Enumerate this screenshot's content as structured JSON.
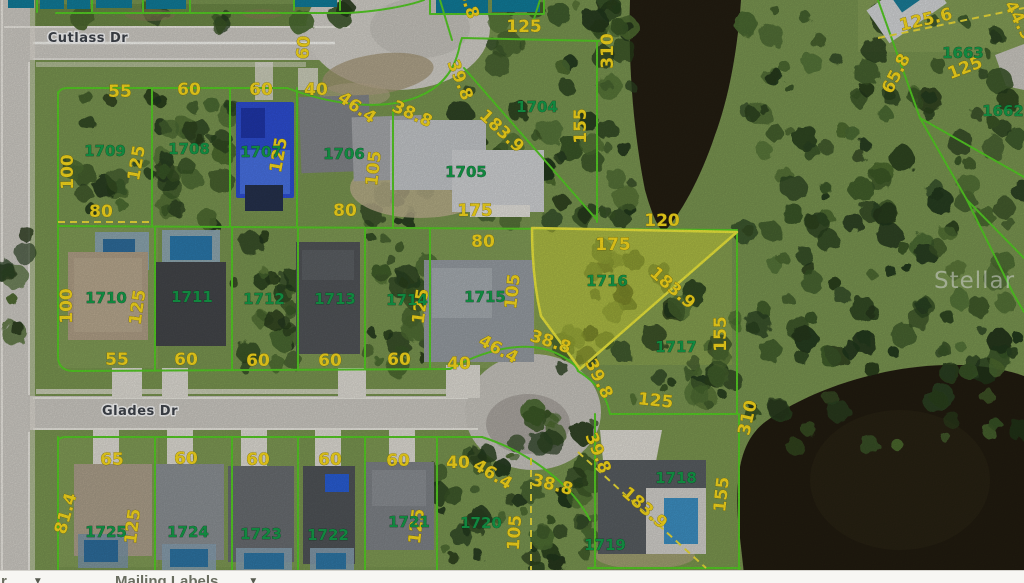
{
  "map": {
    "watermark": "Stellar MLS",
    "streets": [
      {
        "name": "Cutlass Dr",
        "x": 88,
        "y": 42
      },
      {
        "name": "Glades Dr",
        "x": 140,
        "y": 415
      }
    ],
    "lot_numbers": [
      {
        "id": "1704",
        "x": 537,
        "y": 112
      },
      {
        "id": "1705",
        "x": 466,
        "y": 177
      },
      {
        "id": "1706",
        "x": 344,
        "y": 159
      },
      {
        "id": "1707",
        "x": 261,
        "y": 157
      },
      {
        "id": "1708",
        "x": 189,
        "y": 154
      },
      {
        "id": "1709",
        "x": 105,
        "y": 156
      },
      {
        "id": "1710",
        "x": 106,
        "y": 303
      },
      {
        "id": "1711",
        "x": 192,
        "y": 302
      },
      {
        "id": "1712",
        "x": 264,
        "y": 304
      },
      {
        "id": "1713",
        "x": 335,
        "y": 304
      },
      {
        "id": "1714",
        "x": 407,
        "y": 305
      },
      {
        "id": "1715",
        "x": 485,
        "y": 302
      },
      {
        "id": "1716",
        "x": 607,
        "y": 286
      },
      {
        "id": "1717",
        "x": 676,
        "y": 352
      },
      {
        "id": "1718",
        "x": 676,
        "y": 483
      },
      {
        "id": "1719",
        "x": 605,
        "y": 550
      },
      {
        "id": "1720",
        "x": 481,
        "y": 528
      },
      {
        "id": "1721",
        "x": 409,
        "y": 527
      },
      {
        "id": "1722",
        "x": 328,
        "y": 540
      },
      {
        "id": "1723",
        "x": 261,
        "y": 539
      },
      {
        "id": "1724",
        "x": 188,
        "y": 537
      },
      {
        "id": "1725",
        "x": 106,
        "y": 537
      },
      {
        "id": "1662",
        "x": 1003,
        "y": 116
      },
      {
        "id": "1663",
        "x": 963,
        "y": 58
      }
    ],
    "dimensions": [
      {
        "t": "55",
        "x": 120,
        "y": 97
      },
      {
        "t": "60",
        "x": 189,
        "y": 95
      },
      {
        "t": "60",
        "x": 261,
        "y": 95
      },
      {
        "t": "40",
        "x": 316,
        "y": 95
      },
      {
        "t": "60",
        "x": 309,
        "y": 48,
        "r": -85,
        "s": 15
      },
      {
        "t": "100",
        "x": 73,
        "y": 172,
        "r": -90
      },
      {
        "t": "80",
        "x": 101,
        "y": 217
      },
      {
        "t": "125",
        "x": 142,
        "y": 164,
        "r": -80
      },
      {
        "t": "125",
        "x": 284,
        "y": 156,
        "r": -80
      },
      {
        "t": "46.4",
        "x": 354,
        "y": 112,
        "r": 35
      },
      {
        "t": "38.8",
        "x": 410,
        "y": 119,
        "r": 24
      },
      {
        "t": "39.8",
        "x": 455,
        "y": 82,
        "r": 68
      },
      {
        "t": "183.9",
        "x": 498,
        "y": 135,
        "r": 43
      },
      {
        "t": "38.8",
        "x": 462,
        "y": 0,
        "r": 72
      },
      {
        "t": "125",
        "x": 524,
        "y": 32
      },
      {
        "t": "310",
        "x": 613,
        "y": 51,
        "r": -90
      },
      {
        "t": "155",
        "x": 586,
        "y": 126,
        "r": -90
      },
      {
        "t": "105",
        "x": 379,
        "y": 169,
        "r": -84
      },
      {
        "t": "80",
        "x": 345,
        "y": 216
      },
      {
        "t": "175",
        "x": 475,
        "y": 216
      },
      {
        "t": "125.6",
        "x": 927,
        "y": 25,
        "r": -13,
        "s": 15
      },
      {
        "t": "44.9",
        "x": 1014,
        "y": 23,
        "r": 62,
        "s": 15
      },
      {
        "t": "65.8",
        "x": 901,
        "y": 76,
        "r": -63,
        "s": 15
      },
      {
        "t": "125",
        "x": 967,
        "y": 73,
        "r": -21,
        "s": 15
      },
      {
        "t": "100",
        "x": 72,
        "y": 306,
        "r": -90
      },
      {
        "t": "125",
        "x": 143,
        "y": 308,
        "r": -82
      },
      {
        "t": "80",
        "x": 483,
        "y": 247
      },
      {
        "t": "105",
        "x": 518,
        "y": 292,
        "r": -84
      },
      {
        "t": "175",
        "x": 613,
        "y": 250
      },
      {
        "t": "120",
        "x": 662,
        "y": 226
      },
      {
        "t": "183.9",
        "x": 669,
        "y": 292,
        "r": 41
      },
      {
        "t": "155",
        "x": 726,
        "y": 334,
        "r": -90
      },
      {
        "t": "125",
        "x": 426,
        "y": 307,
        "r": -82
      },
      {
        "t": "55",
        "x": 117,
        "y": 365
      },
      {
        "t": "60",
        "x": 186,
        "y": 365
      },
      {
        "t": "60",
        "x": 258,
        "y": 366
      },
      {
        "t": "60",
        "x": 330,
        "y": 366
      },
      {
        "t": "60",
        "x": 399,
        "y": 365
      },
      {
        "t": "40",
        "x": 459,
        "y": 369
      },
      {
        "t": "46.4",
        "x": 496,
        "y": 354,
        "r": 28
      },
      {
        "t": "38.8",
        "x": 549,
        "y": 347,
        "r": 18
      },
      {
        "t": "39.8",
        "x": 594,
        "y": 381,
        "r": 64
      },
      {
        "t": "125",
        "x": 655,
        "y": 406,
        "r": 6
      },
      {
        "t": "65",
        "x": 112,
        "y": 465
      },
      {
        "t": "60",
        "x": 186,
        "y": 464
      },
      {
        "t": "60",
        "x": 258,
        "y": 465
      },
      {
        "t": "60",
        "x": 330,
        "y": 465
      },
      {
        "t": "60",
        "x": 398,
        "y": 466
      },
      {
        "t": "40",
        "x": 458,
        "y": 468
      },
      {
        "t": "46.4",
        "x": 490,
        "y": 479,
        "r": 31
      },
      {
        "t": "38.8",
        "x": 551,
        "y": 490,
        "r": 14
      },
      {
        "t": "39.8",
        "x": 593,
        "y": 455,
        "r": 68
      },
      {
        "t": "81.4",
        "x": 71,
        "y": 515,
        "r": -74
      },
      {
        "t": "125",
        "x": 138,
        "y": 527,
        "r": -83
      },
      {
        "t": "125",
        "x": 422,
        "y": 527,
        "r": -83
      },
      {
        "t": "105",
        "x": 520,
        "y": 533,
        "r": -86
      },
      {
        "t": "183.9",
        "x": 641,
        "y": 512,
        "r": 41
      },
      {
        "t": "310",
        "x": 753,
        "y": 419,
        "r": -77
      },
      {
        "t": "155",
        "x": 727,
        "y": 495,
        "r": -84
      }
    ],
    "colors": {
      "parcel_line_green": "#58D226",
      "dimension_yellow": "#FFE01E",
      "lot_number_green": "#15A04B",
      "highlight_fill": "rgba(216,220,58,0.5)",
      "highlight_border": "#F2EE3E",
      "water": "#241E12",
      "road": "#D2CFC8"
    }
  },
  "toolbar": {
    "partial_left": "r",
    "mailing_labels": "Mailing Labels",
    "caret": "▼"
  }
}
